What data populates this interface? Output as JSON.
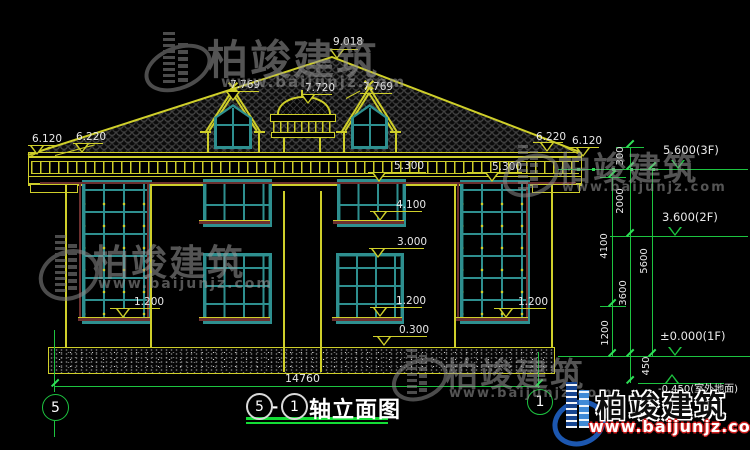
{
  "watermark": {
    "brand": "柏竣建筑",
    "url": "www.baijunjz.com"
  },
  "roof_labels": {
    "ridge": "9.018",
    "cupola": "7.720",
    "dormer_left": "7.769",
    "dormer_right": "7.769"
  },
  "eave_labels": {
    "far_left": "6.120",
    "left": "6.220",
    "right": "6.220",
    "far_right": "6.120"
  },
  "level_labels": {
    "eave_center": "5.300",
    "eave_right": "5.300",
    "sill_2f": "4.100",
    "head_1f": "3.000",
    "sill_left": "1.200",
    "sill_center": "1.200",
    "sill_right": "1.200",
    "plinth": "0.300"
  },
  "floor_levels": {
    "f3": "5.600(3F)",
    "f2": "3.600(2F)",
    "f1": "±0.000(1F)",
    "ground": "-0.450(室外地面)"
  },
  "vertical_dims": {
    "v300": "300",
    "v2000": "2000",
    "v4100": "4100",
    "v5600": "5600",
    "v3600": "3600",
    "v1200": "1200",
    "v450": "450"
  },
  "width_dim": "14760",
  "axes": {
    "left": "5",
    "right": "1"
  },
  "title": {
    "axis_start": "5",
    "dash": "-",
    "axis_end": "1",
    "name": "轴立面图"
  },
  "colors": {
    "cad_yellow": "#cfcf2a",
    "cad_green": "#1dc440",
    "window_teal": "#2e8f8f",
    "dim_text": "#e8e8e8",
    "trim_red": "#6b2f2f",
    "brand_blue": "#1c57b0",
    "url_red": "#d42020"
  }
}
